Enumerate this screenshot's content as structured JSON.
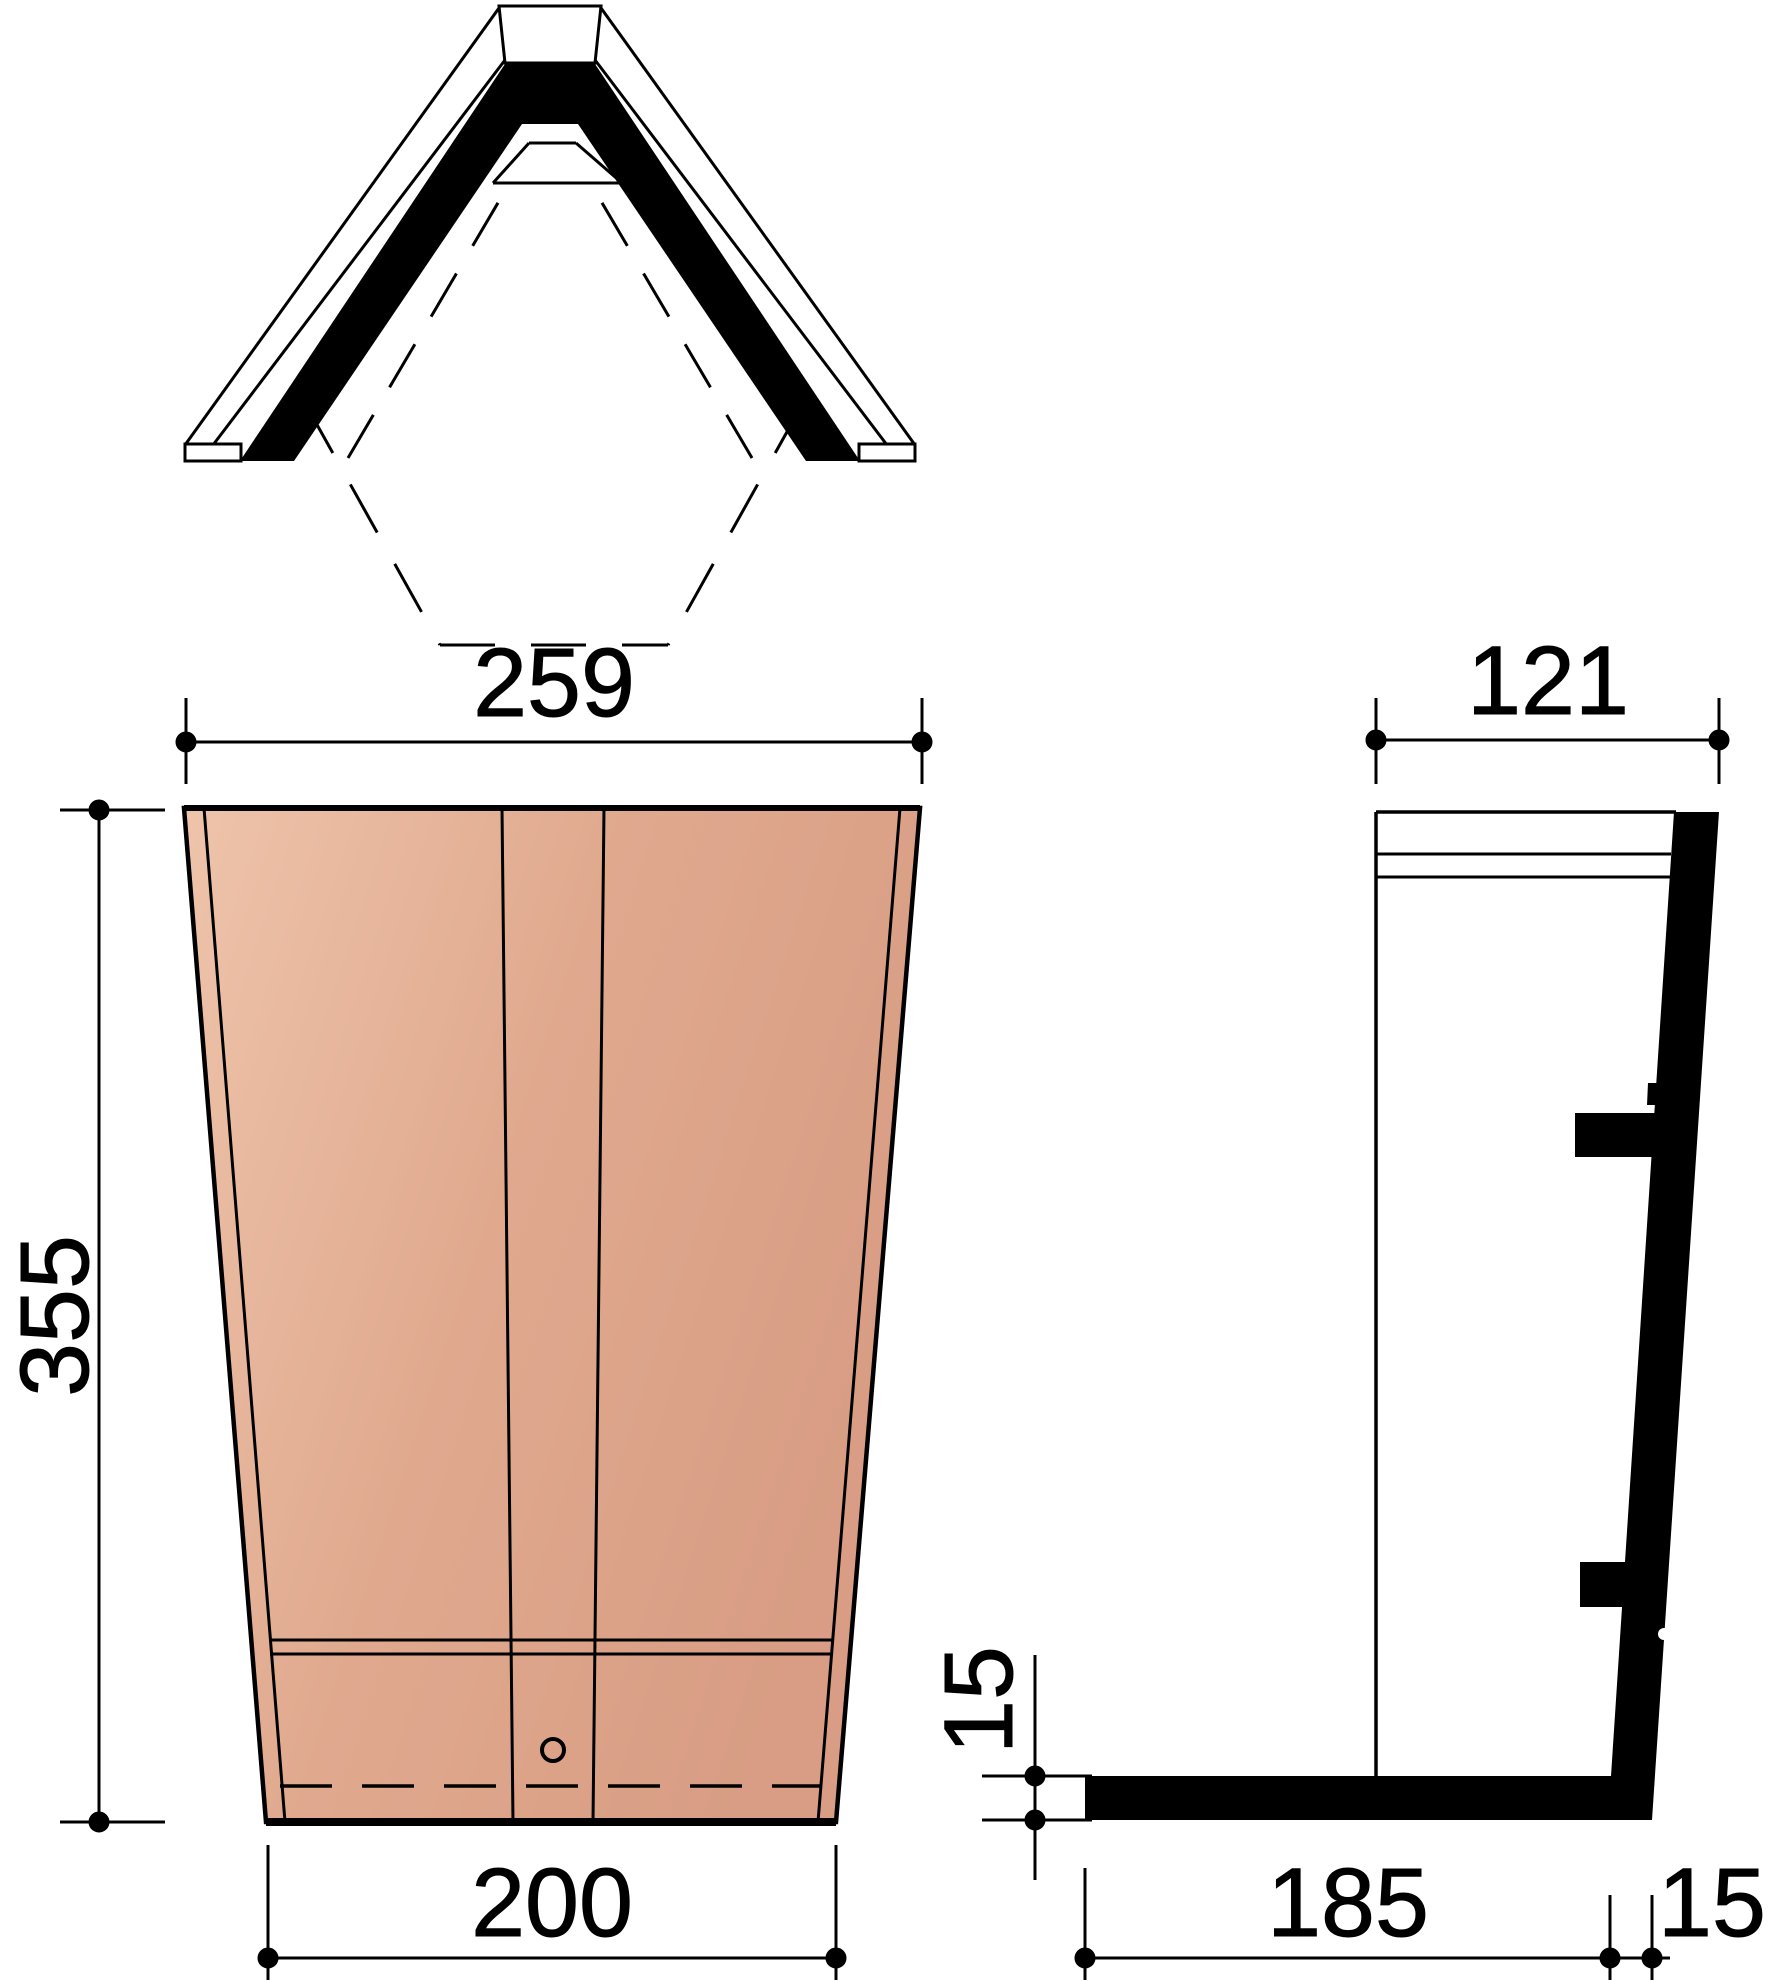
{
  "drawing": {
    "type": "technical-drawing",
    "subject": "angle ridge roof tile - three orthographic views",
    "colors": {
      "background": "#ffffff",
      "line": "#000000",
      "tile_light": "#eec4ab",
      "tile_mid": "#e0a98e",
      "tile_dark": "#d89d84"
    },
    "views": {
      "top_view": {
        "label": "plan view"
      },
      "front_view": {
        "label": "front elevation"
      },
      "side_view": {
        "label": "side elevation"
      }
    },
    "dimensions": {
      "front_top_width": "259",
      "front_height": "355",
      "front_bottom_width": "200",
      "side_top_width": "121",
      "side_foot_height": "15",
      "side_bottom_length": "185",
      "side_bottom_thickness": "15"
    }
  }
}
